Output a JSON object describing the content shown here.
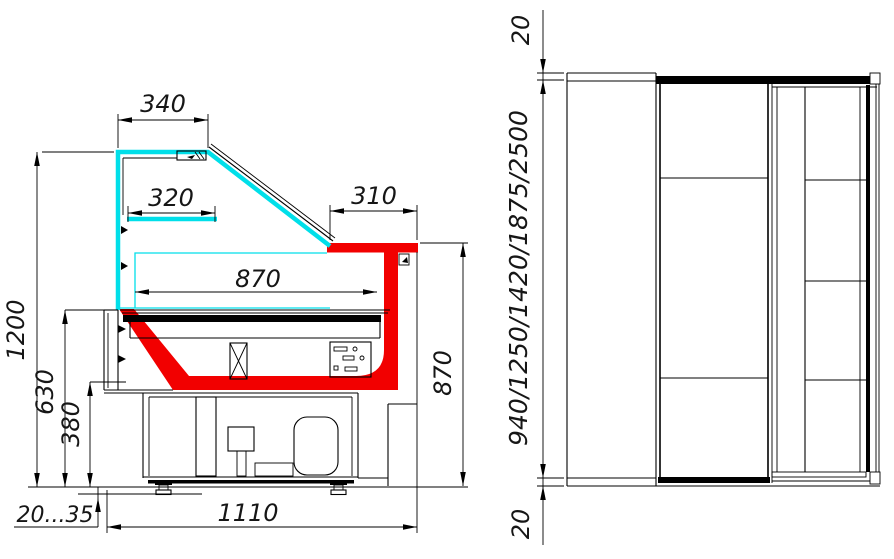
{
  "drawing": {
    "type": "refrigerated showcase technical drawing",
    "colors": {
      "glass": "#00dfe9",
      "accent_red": "#f20000",
      "line": "#000000",
      "background": "#ffffff"
    },
    "side_section_view": {
      "dims": {
        "top_glass_depth": "340",
        "shelf_depth": "320",
        "counter_overhang": "310",
        "display_depth": "870",
        "overall_height": "1200",
        "well_height": "630",
        "base_height": "380",
        "counter_height": "870",
        "leg_adjust_range": "20...35",
        "overall_depth": "1110"
      }
    },
    "front_view": {
      "dims": {
        "top_offset": "20",
        "height_options": "940/1250/1420/1875/2500",
        "bottom_offset": "20"
      }
    }
  }
}
